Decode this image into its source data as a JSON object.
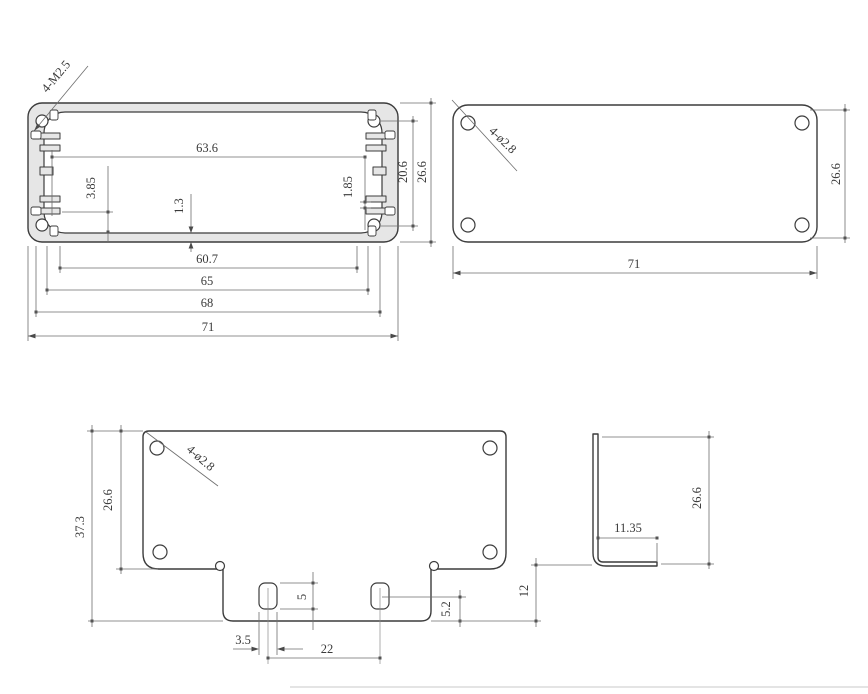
{
  "labels": {
    "profile": {
      "callout": "4-M2.5",
      "inner_width": "63.6",
      "slot_left": "3.85",
      "floor": "1.3",
      "slot_right": "1.85",
      "boss_pitch": "20.6",
      "height": "26.6",
      "w_inner": "60.7",
      "w_mid": "65",
      "w_outer": "68",
      "w_overall": "71"
    },
    "end_plate": {
      "callout": "4-ø2.8",
      "height": "26.6",
      "width": "71"
    },
    "flat_pattern": {
      "callout": "4-ø2.8",
      "overall_height": "37.3",
      "plate_height": "26.6",
      "slot_height": "5",
      "slot_center": "5.2",
      "slot_width": "3.5",
      "slot_pitch": "22",
      "flange_height": "12"
    },
    "side_view": {
      "flange_length": "11.35",
      "height": "26.6"
    }
  }
}
